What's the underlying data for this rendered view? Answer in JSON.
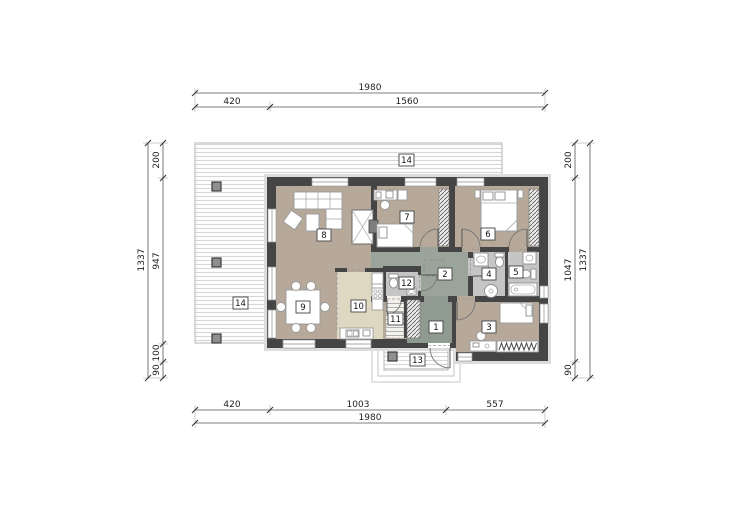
{
  "type": "architectural-floor-plan",
  "dimensions": {
    "top": {
      "total": "1980",
      "a": "420",
      "b": "1560"
    },
    "bottom": {
      "a": "420",
      "b": "1003",
      "c": "557",
      "total": "1980"
    },
    "left": {
      "a": "200",
      "b": "947",
      "c": "100",
      "d": "90",
      "total": "1337"
    },
    "right": {
      "a": "200",
      "b": "1047",
      "c": "90",
      "total": "1337"
    }
  },
  "rooms": {
    "n1": "1",
    "n2": "2",
    "n3": "3",
    "n4": "4",
    "n5": "5",
    "n6": "6",
    "n7": "7",
    "n8": "8",
    "n9": "9",
    "n10": "10",
    "n11": "11",
    "n12": "12",
    "n13": "13",
    "n14": "14"
  },
  "colors": {
    "floor_beige": "#b6a99a",
    "floor_hall": "#9aa49a",
    "floor_entry": "#8f9a90",
    "floor_kitchen": "#ded8c2",
    "floor_bath": "#c5c5c5",
    "wall": "#454545",
    "wall_band": "#dcdcdc",
    "terrace_line": "#d6d6d6"
  }
}
